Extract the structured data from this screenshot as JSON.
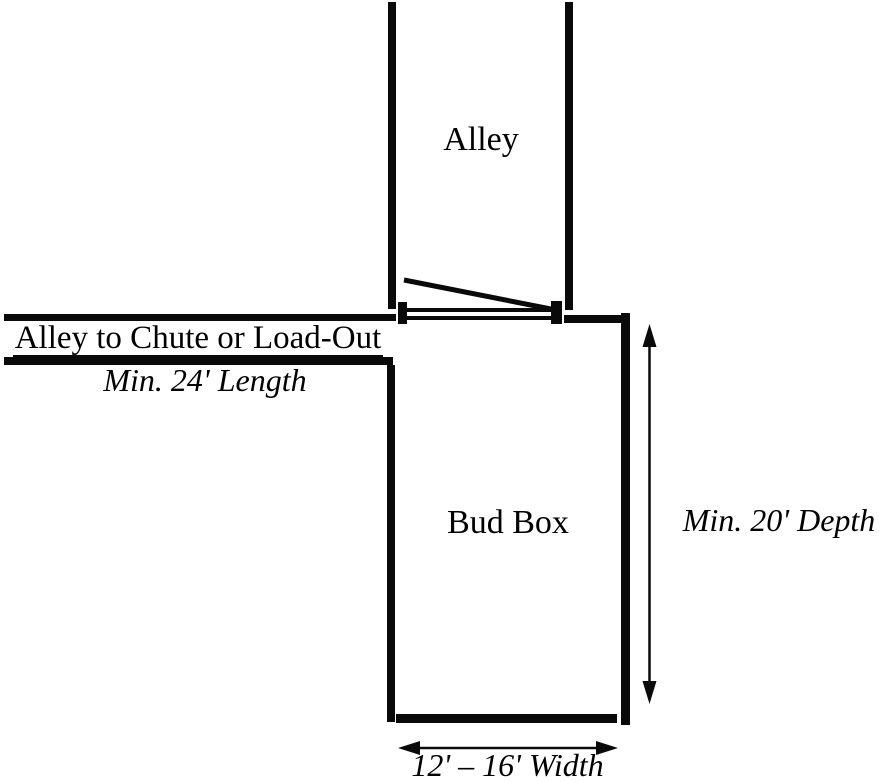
{
  "page": {
    "background_color": "#ffffff",
    "ink_color": "#000000"
  },
  "diagram": {
    "alley": {
      "label": "Alley"
    },
    "chute_lane": {
      "label": "Alley to Chute or Load-Out",
      "dimension": "Min. 24' Length"
    },
    "bud_box": {
      "label": "Bud Box"
    },
    "depth": {
      "dimension": "Min. 20' Depth"
    },
    "width": {
      "dimension": "12' – 16' Width"
    }
  }
}
